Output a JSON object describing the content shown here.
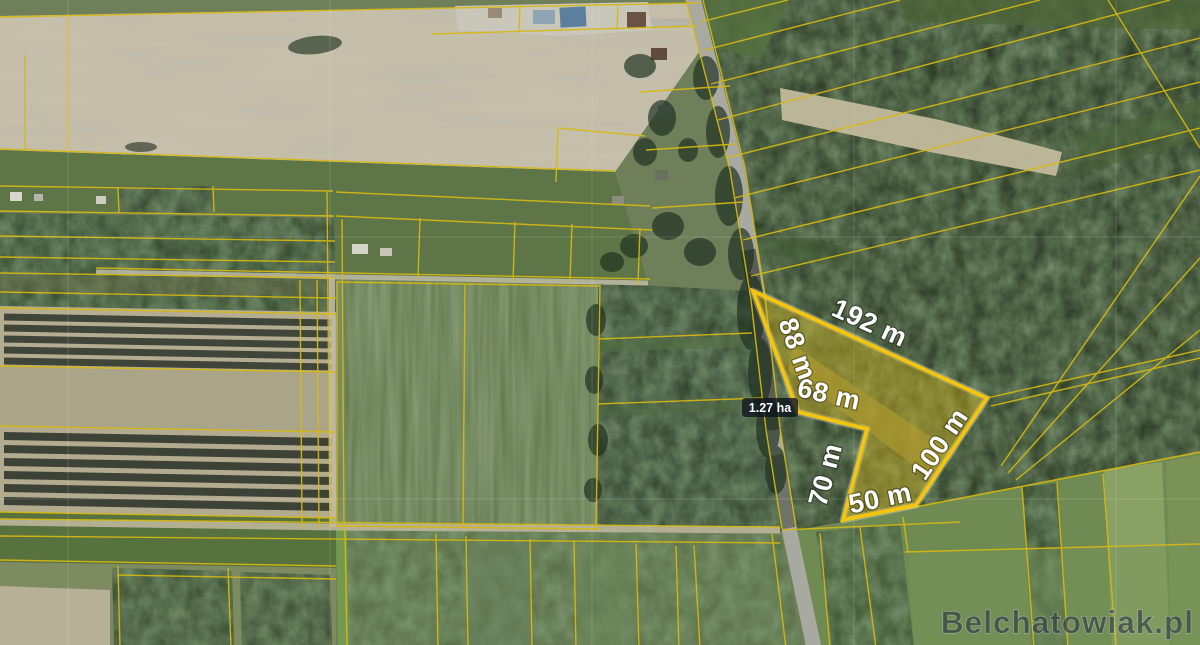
{
  "map": {
    "area_badge": "1.27 ha",
    "dimensions": [
      {
        "edge": "top",
        "label": "192 m"
      },
      {
        "edge": "northwest",
        "label": "88 m"
      },
      {
        "edge": "inner-upper",
        "label": "68 m"
      },
      {
        "edge": "inner-lower",
        "label": "70 m"
      },
      {
        "edge": "south",
        "label": "50 m"
      },
      {
        "edge": "southeast",
        "label": "100 m"
      }
    ],
    "watermark": "Belchatowiak.pl",
    "colors": {
      "parcel_outline": "#f3c50f",
      "parcel_fill": "rgba(214,180,26,0.42)",
      "cadastral_line": "#d7b911",
      "label_text": "#ffffff",
      "badge_background": "rgba(13,19,31,0.78)"
    }
  }
}
